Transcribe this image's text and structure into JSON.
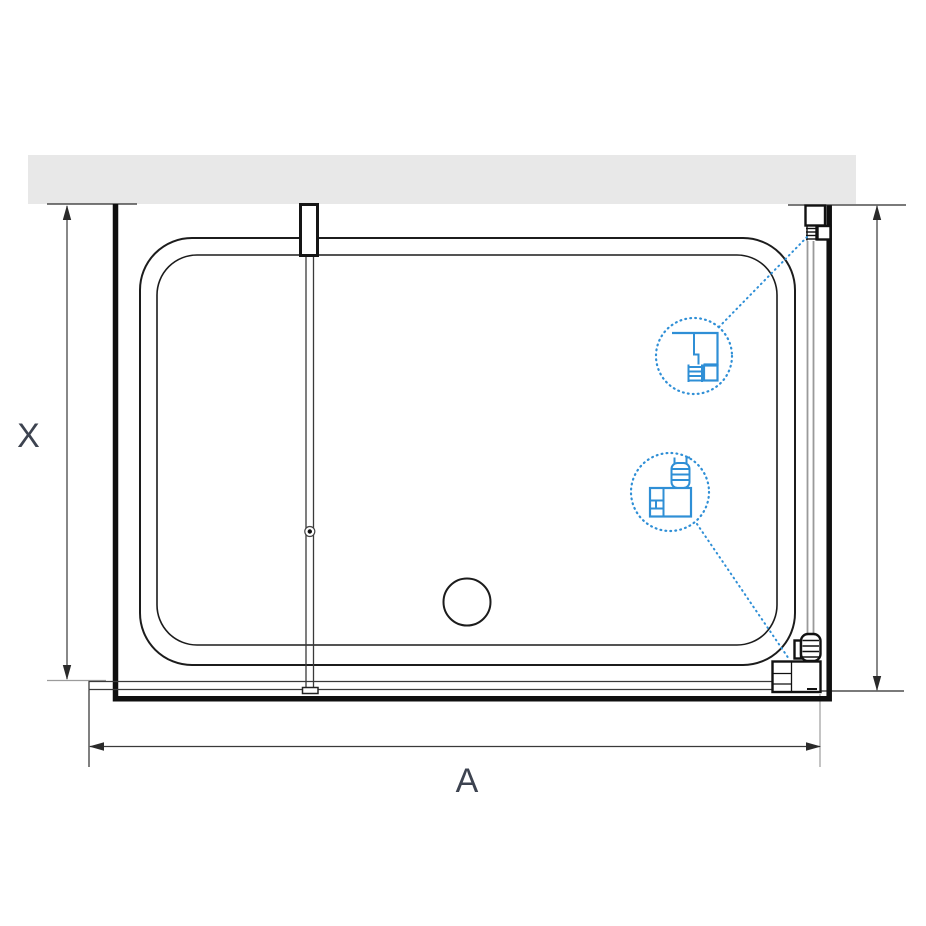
{
  "page": {
    "title": "Shower enclosure technical drawing - top view"
  },
  "dimensions": {
    "horizontal_label": "A",
    "vertical_left_label": "X"
  },
  "details": {
    "upper": "wall-profile-cross-section",
    "lower": "floor-profile-cross-section"
  },
  "colors": {
    "wall_fill": "#e8e8e8",
    "accent_blue": "#2f8fd6",
    "line": "#1c1c1c",
    "glass_gray": "#9a9a9a",
    "dim_label": "#3d4350"
  }
}
